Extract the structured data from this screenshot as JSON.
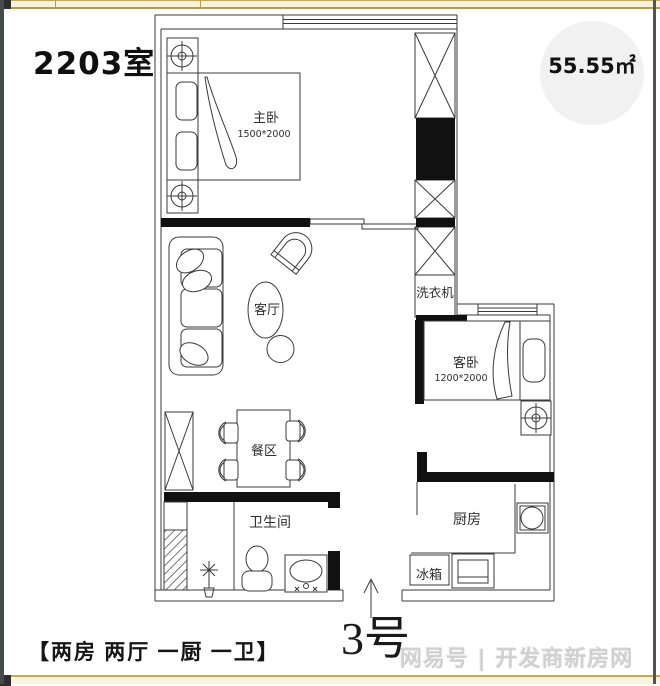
{
  "header": {
    "unit_label": "2203室",
    "area_label": "55.55㎡"
  },
  "rooms": {
    "master_bedroom": {
      "label": "主卧",
      "size": "1500*2000"
    },
    "living_room": {
      "label": "客厅"
    },
    "guest_bedroom": {
      "label": "客卧",
      "size": "1200*2000"
    },
    "dining_area": {
      "label": "餐区"
    },
    "bathroom": {
      "label": "卫生间"
    },
    "kitchen": {
      "label": "厨房"
    },
    "fridge": {
      "label": "冰箱"
    },
    "washing_machine": {
      "label": "洗衣机"
    }
  },
  "footer": {
    "layout_label": "【两房 两厅 一厨 一卫】",
    "unit_number": "3号",
    "watermark": "网易号 | 开发商新房网"
  },
  "colors": {
    "accent_bar": "#c9a94f",
    "bar_fill": "#f8f3dc",
    "page_border": "#454b4b",
    "wall_black": "#111111",
    "thin_line": "#3a3a3a",
    "area_badge_bg": "#f1f1f1",
    "watermark_gray": "#d0d0d0"
  }
}
